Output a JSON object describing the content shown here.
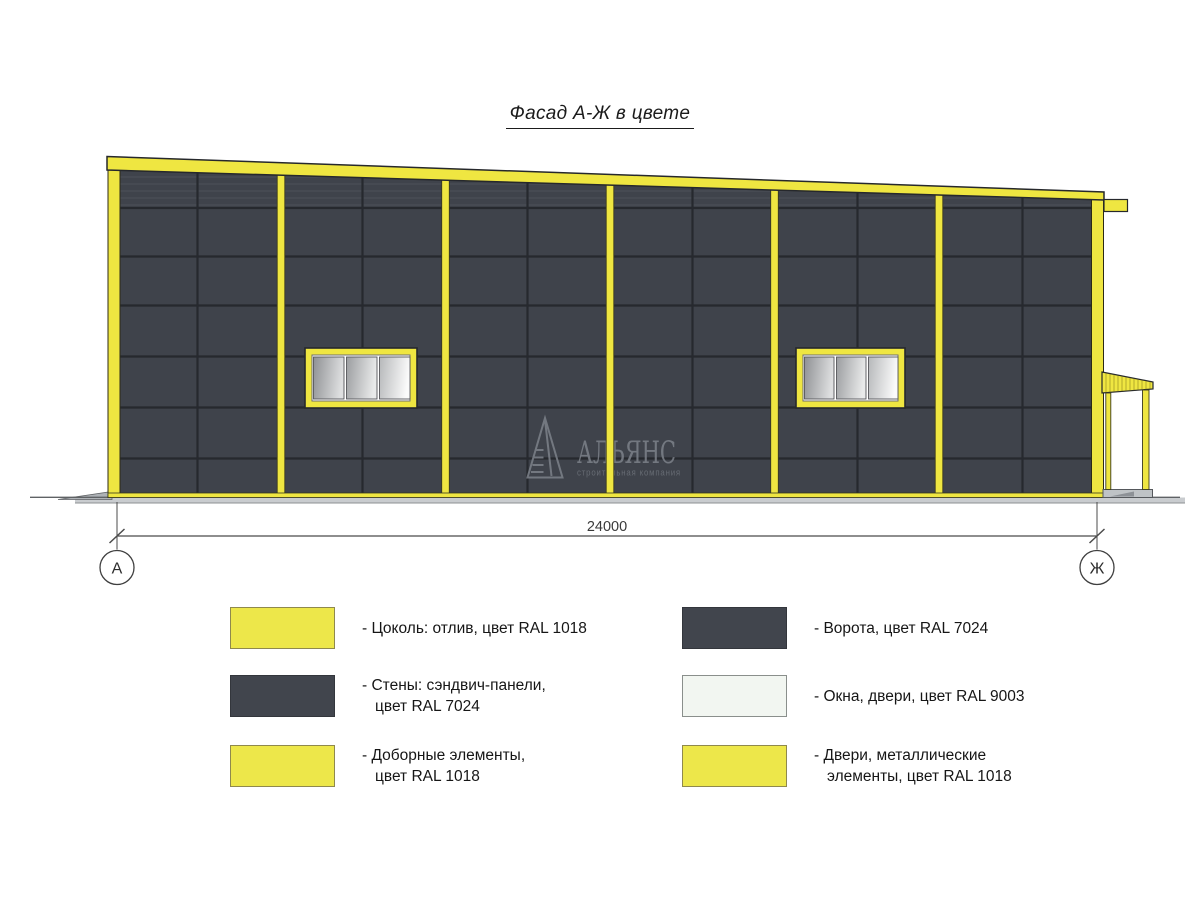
{
  "title": "Фасад А-Ж в цвете",
  "drawing": {
    "dimension_label": "24000",
    "axis_left": "А",
    "axis_right": "Ж"
  },
  "watermark": {
    "name": "АЛЬЯНС",
    "subtitle": "строительная компания"
  },
  "colors": {
    "ral1018_yellow": "#EFE641",
    "ral7024_gray": "#3F434B",
    "ral9003_white": "#F2F6F1",
    "panel_joint": "#26292e",
    "ground_gray": "#c9cccf"
  },
  "legend": {
    "items": [
      {
        "swatch_color": "#EDE74A",
        "label": "- Цоколь: отлив, цвет RAL 1018"
      },
      {
        "swatch_color": "#41454D",
        "label": "- Стены: сэндвич-панели,\nцвет RAL 7024"
      },
      {
        "swatch_color": "#EDE74A",
        "label": "- Доборные элементы,\nцвет RAL 1018"
      },
      {
        "swatch_color": "#41454D",
        "label": "- Ворота, цвет RAL 7024"
      },
      {
        "swatch_color": "#F2F6F1",
        "label": "- Окна, двери, цвет RAL 9003"
      },
      {
        "swatch_color": "#EDE74A",
        "label": "- Двери, металлические\nэлементы, цвет RAL 1018"
      }
    ]
  }
}
